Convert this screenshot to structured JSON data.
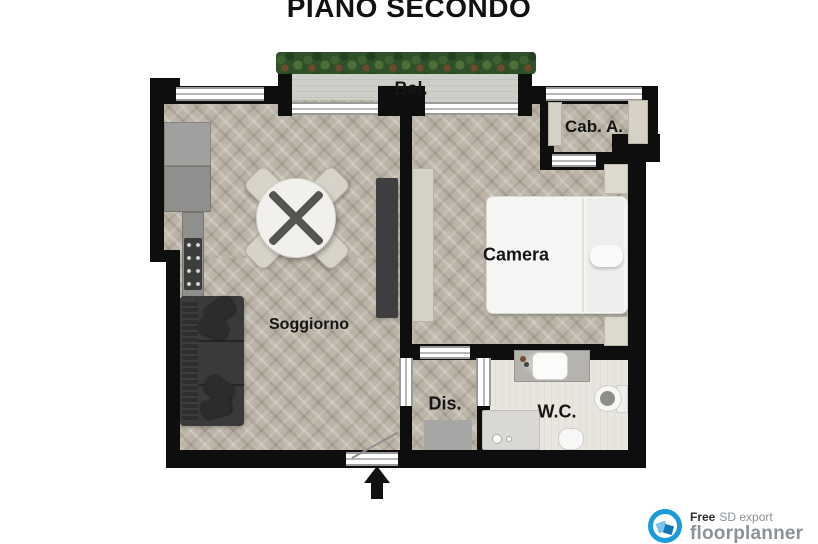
{
  "title": "PIANO SECONDO",
  "rooms": {
    "balcony": {
      "label": "Bal."
    },
    "cabina": {
      "label": "Cab. A."
    },
    "camera": {
      "label": "Camera"
    },
    "soggiorno": {
      "label": "Soggiorno"
    },
    "disimpegno": {
      "label": "Dis."
    },
    "wc": {
      "label": "W.C."
    }
  },
  "footer": {
    "free_label": "Free",
    "export_label": "SD export",
    "brand": "floorplanner"
  },
  "colors": {
    "wall": "#0e0e0e",
    "wood_floor": "#bcb4a7",
    "balcony_floor": "#ccd0c8",
    "wc_floor": "#e8e6df",
    "greenery": "#30502a",
    "brand_blue": "#1b9bd8",
    "brand_gray": "#8b9298",
    "label_text": "#151515"
  }
}
